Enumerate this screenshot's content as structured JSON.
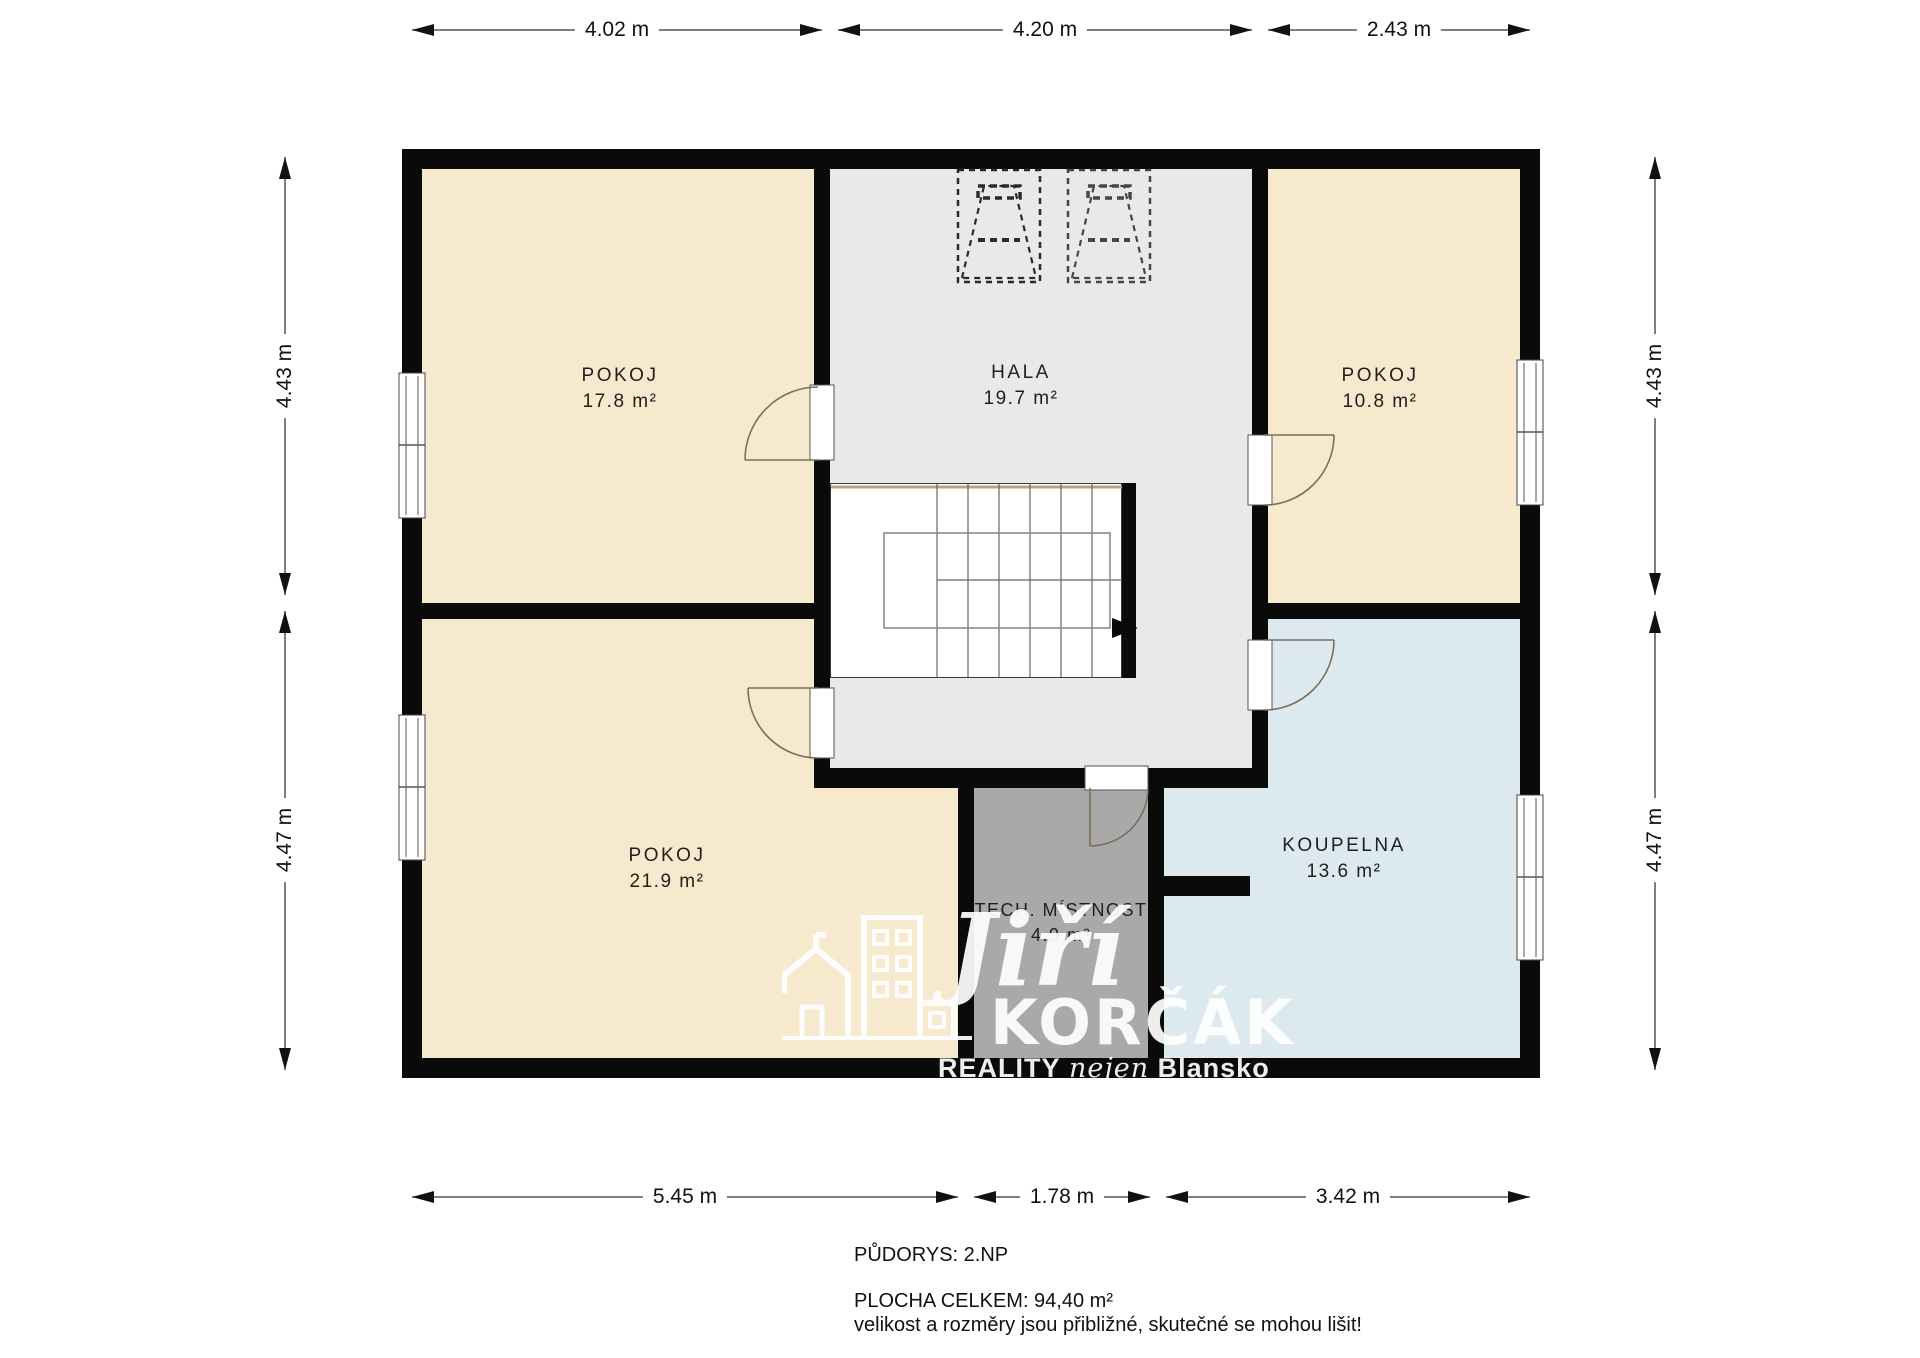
{
  "floor_plan": {
    "title": "PŮDORYS: 2.NP",
    "rooms": [
      {
        "name": "POKOJ",
        "area": "17.8 m²"
      },
      {
        "name": "HALA",
        "area": "19.7 m²"
      },
      {
        "name": "POKOJ",
        "area": "10.8 m²"
      },
      {
        "name": "POKOJ",
        "area": "21.9 m²"
      },
      {
        "name": "TECH. MÍSTNOST",
        "area": "4.9 m²"
      },
      {
        "name": "KOUPELNA",
        "area": "13.6 m²"
      }
    ],
    "dimensions": {
      "top": [
        "4.02 m",
        "4.20 m",
        "2.43 m"
      ],
      "bottom": [
        "5.45 m",
        "1.78 m",
        "3.42 m"
      ],
      "left": [
        "4.43 m",
        "4.47 m"
      ],
      "right": [
        "4.43 m",
        "4.47 m"
      ]
    },
    "footer": {
      "line1": "PŮDORYS: 2.NP",
      "line2": "PLOCHA CELKEM: 94,40  m²",
      "line3": "velikost a rozměry jsou přibližné, skutečné se mohou lišit!"
    },
    "watermark": {
      "script": "Jiří",
      "name": "KORČÁK",
      "tagline_1": "REALITY",
      "tagline_2": "nejen",
      "tagline_3": "Blansko"
    },
    "colors": {
      "room_cream": "#F6E9CE",
      "hall_grey": "#E9E9E7",
      "tech_grey": "#A9A9A9",
      "bath_blue": "#DCEAEF",
      "wall_black": "#0A0A0A",
      "door_arc": "#7d6e55",
      "dimension_line": "#555555"
    }
  }
}
